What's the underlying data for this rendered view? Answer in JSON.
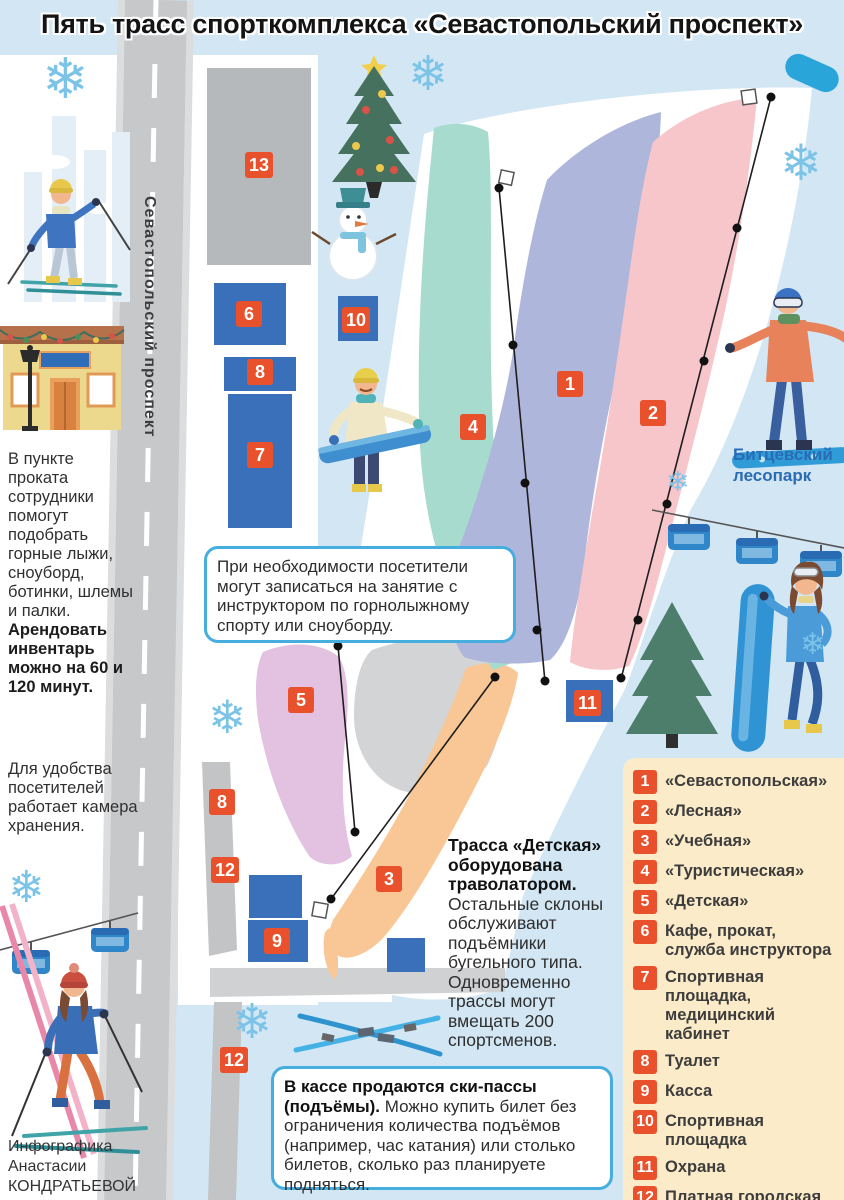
{
  "title": "Пять трасс спорткомплекса «Севастопольский проспект»",
  "road_label": "Севастопольский проспект",
  "forest_label": "Битцевский лесопарк",
  "credit": "Инфографика Анастасии КОНДРАТЬЕВОЙ",
  "icons": {
    "snowflake": "❄"
  },
  "info": {
    "rental_text": "В пункте проката сотрудники помогут подобрать горные лыжи, сноуборд, ботинки, шлемы и палки. ",
    "rental_bold": "Арендовать инвентарь можно на 60 и 120 минут.",
    "storage_text": "Для удобства посетителей работает камера хранения.",
    "detskaya_bold": "Трасса «Детская» оборудована траволатором. ",
    "detskaya_text": "Остальные склоны обслуживают подъёмники бугельного типа. Одновременно трассы могут вмещать 200 спортсменов."
  },
  "callouts": {
    "instructor": "При необходимости посетители могут записаться на занятие с инструктором по горнолыжному спорту или сноуборду.",
    "tickets_bold": "В кассе продаются ски-пассы (подъёмы). ",
    "tickets_text": "Можно купить билет без ограничения количества подъёмов (например, час катания) или столько билетов, сколько раз планируете подняться."
  },
  "legend": {
    "items": [
      {
        "num": "1",
        "label": "«Севастопольская»"
      },
      {
        "num": "2",
        "label": "«Лесная»"
      },
      {
        "num": "3",
        "label": "«Учебная»"
      },
      {
        "num": "4",
        "label": "«Туристическая»"
      },
      {
        "num": "5",
        "label": "«Детская»"
      },
      {
        "num": "6",
        "label": "Кафе, прокат, служба инструктора"
      },
      {
        "num": "7",
        "label": "Спортивная площадка, медицинский кабинет"
      },
      {
        "num": "8",
        "label": "Туалет"
      },
      {
        "num": "9",
        "label": "Касса"
      },
      {
        "num": "10",
        "label": "Спортивная площадка"
      },
      {
        "num": "11",
        "label": "Охрана"
      },
      {
        "num": "12",
        "label": "Платная городская парковка"
      },
      {
        "num": "13",
        "label": "Парковка"
      }
    ]
  },
  "map": {
    "markers": [
      {
        "num": "1",
        "x": 557,
        "y": 371
      },
      {
        "num": "2",
        "x": 640,
        "y": 400
      },
      {
        "num": "3",
        "x": 376,
        "y": 866
      },
      {
        "num": "4",
        "x": 460,
        "y": 414
      },
      {
        "num": "5",
        "x": 288,
        "y": 687
      },
      {
        "num": "6",
        "x": 236,
        "y": 301
      },
      {
        "num": "7",
        "x": 247,
        "y": 442
      },
      {
        "num": "8",
        "x": 247,
        "y": 359
      },
      {
        "num": "8",
        "x": 209,
        "y": 789
      },
      {
        "num": "9",
        "x": 264,
        "y": 928
      },
      {
        "num": "10",
        "x": 342,
        "y": 307
      },
      {
        "num": "11",
        "x": 574,
        "y": 690
      },
      {
        "num": "12",
        "x": 211,
        "y": 857
      },
      {
        "num": "12",
        "x": 220,
        "y": 1047
      },
      {
        "num": "13",
        "x": 245,
        "y": 152
      }
    ]
  },
  "colors": {
    "marker": "#e8512b",
    "trail_1_sevastopolskaya": "#aeb6dc",
    "trail_2_lesnaya": "#f7c6ca",
    "trail_3_uchebnaya": "#f9c795",
    "trail_4_turisticheskaya": "#a7dbce",
    "trail_5_detskaya": "#e3c1e1",
    "building_blue": "#3a70ba",
    "legend_bg": "#fcebc8",
    "callout_border": "#45aede",
    "forest_label_color": "#2a6cb4",
    "map_bg": "#d2e6f4"
  }
}
